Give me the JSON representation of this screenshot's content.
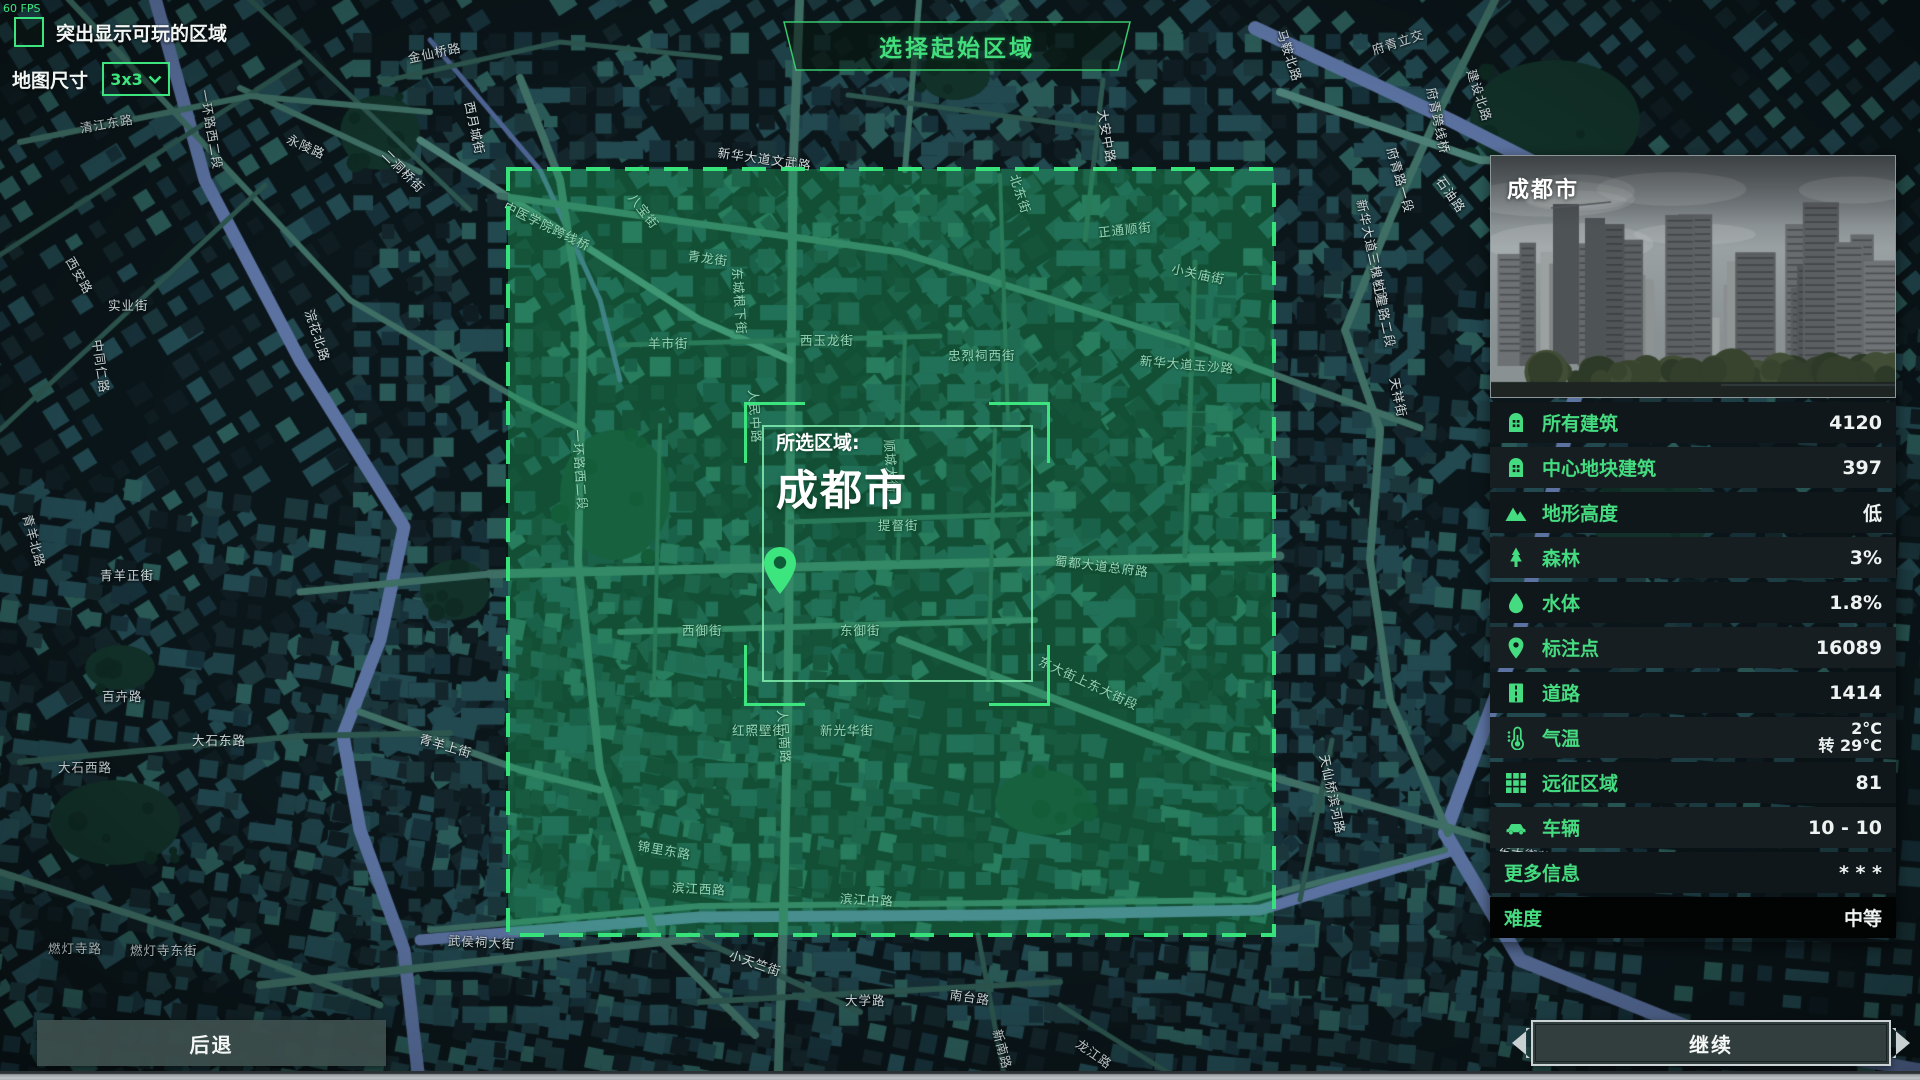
{
  "hud": {
    "fps": "60 FPS",
    "highlight_checkbox_label": "突出显示可玩的区域",
    "highlight_checked": false,
    "map_size_label": "地图尺寸",
    "map_size_value": "3x3"
  },
  "title": "选择起始区域",
  "selection": {
    "prefix": "所选区域:",
    "city": "成都市"
  },
  "panel": {
    "city_name": "成都市",
    "stats": [
      {
        "icon": "building-icon",
        "label": "所有建筑",
        "value": "4120"
      },
      {
        "icon": "building-icon",
        "label": "中心地块建筑",
        "value": "397"
      },
      {
        "icon": "mountain-icon",
        "label": "地形高度",
        "value": "低"
      },
      {
        "icon": "tree-icon",
        "label": "森林",
        "value": "3%"
      },
      {
        "icon": "water-drop-icon",
        "label": "水体",
        "value": "1.8%"
      },
      {
        "icon": "map-pin-icon",
        "label": "标注点",
        "value": "16089"
      },
      {
        "icon": "road-icon",
        "label": "道路",
        "value": "1414"
      },
      {
        "icon": "thermometer-icon",
        "label": "气温",
        "value": "2°C",
        "value2": "转 29°C"
      },
      {
        "icon": "grid-icon",
        "label": "远征区域",
        "value": "81"
      },
      {
        "icon": "car-icon",
        "label": "车辆",
        "value": "10 - 10"
      }
    ],
    "more_info": {
      "label": "更多信息",
      "value": "* * *"
    },
    "difficulty": {
      "label": "难度",
      "value": "中等"
    }
  },
  "buttons": {
    "back": "后退",
    "continue": "继续"
  },
  "colors": {
    "accent": "#3ce57d",
    "label_green": "#45db80",
    "value_white": "#eef3f2",
    "map_base": "#0b161a",
    "river": "#5c73a2",
    "river_thin": "#4d6391",
    "park": "#123129",
    "road_major": "#3e6e64",
    "road_bright": "#4c8076",
    "road_minor": "#2d564f",
    "buildings": [
      "#14262b",
      "#1b373c",
      "#224850",
      "#17313a",
      "#0f1d22",
      "#1e4147",
      "#2a5a57"
    ],
    "selection_fill": "rgba(34,197,107,0.33)",
    "selection_stroke": "#37e27a"
  },
  "map": {
    "street_labels": [
      {
        "t": "清江东路",
        "x": 80,
        "y": 118,
        "r": -10
      },
      {
        "t": "一环路西二段",
        "x": 205,
        "y": 80,
        "r": 80
      },
      {
        "t": "永陵路",
        "x": 288,
        "y": 128,
        "r": 24
      },
      {
        "t": "中医学院跨线桥",
        "x": 505,
        "y": 195,
        "r": 26
      },
      {
        "t": "浣花北路",
        "x": 310,
        "y": 300,
        "r": 72
      },
      {
        "t": "一环路西二段",
        "x": 578,
        "y": 420,
        "r": 86
      },
      {
        "t": "青羊上街",
        "x": 420,
        "y": 728,
        "r": 16
      },
      {
        "t": "青羊正街",
        "x": 100,
        "y": 565,
        "r": 0
      },
      {
        "t": "青羊北路",
        "x": 28,
        "y": 505,
        "r": 75
      },
      {
        "t": "西安路",
        "x": 70,
        "y": 248,
        "r": 60
      },
      {
        "t": "实业街",
        "x": 108,
        "y": 295,
        "r": 0
      },
      {
        "t": "中同仁路",
        "x": 98,
        "y": 330,
        "r": 82
      },
      {
        "t": "西月城街",
        "x": 470,
        "y": 92,
        "r": 78
      },
      {
        "t": "金仙桥路",
        "x": 408,
        "y": 48,
        "r": -12
      },
      {
        "t": "二洞桥街",
        "x": 385,
        "y": 142,
        "r": 45
      },
      {
        "t": "八宝街",
        "x": 632,
        "y": 185,
        "r": 52
      },
      {
        "t": "青龙街",
        "x": 688,
        "y": 245,
        "r": 8
      },
      {
        "t": "东城根下街",
        "x": 738,
        "y": 258,
        "r": 86
      },
      {
        "t": "羊市街",
        "x": 648,
        "y": 333,
        "r": 0
      },
      {
        "t": "西玉龙街",
        "x": 800,
        "y": 330,
        "r": 0
      },
      {
        "t": "新华大道文武路",
        "x": 718,
        "y": 142,
        "r": 8
      },
      {
        "t": "正通顺街",
        "x": 1098,
        "y": 222,
        "r": -6
      },
      {
        "t": "北东街",
        "x": 1015,
        "y": 165,
        "r": 72
      },
      {
        "t": "小关庙街",
        "x": 1172,
        "y": 258,
        "r": 12
      },
      {
        "t": "大安中路",
        "x": 1103,
        "y": 100,
        "r": 80
      },
      {
        "t": "府青立交",
        "x": 1372,
        "y": 40,
        "r": -18
      },
      {
        "t": "府青跨线桥",
        "x": 1432,
        "y": 78,
        "r": 78
      },
      {
        "t": "府青路一段",
        "x": 1392,
        "y": 138,
        "r": 74
      },
      {
        "t": "石油路",
        "x": 1440,
        "y": 168,
        "r": 55
      },
      {
        "t": "马鞍北路",
        "x": 1282,
        "y": 20,
        "r": 72
      },
      {
        "t": "新华大道三槐树路",
        "x": 1362,
        "y": 190,
        "r": 78
      },
      {
        "t": "建设北路",
        "x": 1472,
        "y": 60,
        "r": 72
      },
      {
        "t": "天祥街",
        "x": 1395,
        "y": 368,
        "r": 78
      },
      {
        "t": "红星路二段",
        "x": 1378,
        "y": 272,
        "r": 78
      },
      {
        "t": "新华大道玉沙路",
        "x": 1140,
        "y": 350,
        "r": 5
      },
      {
        "t": "忠烈祠西街",
        "x": 948,
        "y": 345,
        "r": 0
      },
      {
        "t": "顺城大街",
        "x": 890,
        "y": 430,
        "r": 86
      },
      {
        "t": "人民中路",
        "x": 754,
        "y": 380,
        "r": 86
      },
      {
        "t": "提督街",
        "x": 878,
        "y": 515,
        "r": 0
      },
      {
        "t": "蜀都大道总府路",
        "x": 1055,
        "y": 550,
        "r": 7
      },
      {
        "t": "西御街",
        "x": 682,
        "y": 620,
        "r": 0
      },
      {
        "t": "东御街",
        "x": 840,
        "y": 620,
        "r": 0
      },
      {
        "t": "人民南路",
        "x": 783,
        "y": 700,
        "r": 86
      },
      {
        "t": "东大街上东大街段",
        "x": 1040,
        "y": 650,
        "r": 25
      },
      {
        "t": "红照壁街",
        "x": 732,
        "y": 720,
        "r": 0
      },
      {
        "t": "新光华街",
        "x": 820,
        "y": 720,
        "r": 0
      },
      {
        "t": "滨江西路",
        "x": 672,
        "y": 877,
        "r": 3
      },
      {
        "t": "滨江中路",
        "x": 840,
        "y": 888,
        "r": 3
      },
      {
        "t": "锦里东路",
        "x": 638,
        "y": 835,
        "r": 10
      },
      {
        "t": "武侯祠大街",
        "x": 448,
        "y": 930,
        "r": 3
      },
      {
        "t": "小天竺街",
        "x": 730,
        "y": 944,
        "r": 19
      },
      {
        "t": "大学路",
        "x": 845,
        "y": 990,
        "r": 0
      },
      {
        "t": "南台路",
        "x": 950,
        "y": 984,
        "r": 8
      },
      {
        "t": "龙江路",
        "x": 1078,
        "y": 1032,
        "r": 35
      },
      {
        "t": "新南路",
        "x": 998,
        "y": 1020,
        "r": 75
      },
      {
        "t": "燃灯寺路",
        "x": 48,
        "y": 938,
        "r": 0
      },
      {
        "t": "燃灯寺东街",
        "x": 130,
        "y": 940,
        "r": 0
      },
      {
        "t": "百卉路",
        "x": 102,
        "y": 686,
        "r": 0
      },
      {
        "t": "大石西路",
        "x": 58,
        "y": 757,
        "r": 0
      },
      {
        "t": "大石东路",
        "x": 192,
        "y": 730,
        "r": 0
      },
      {
        "t": "天仙桥滨河路",
        "x": 1325,
        "y": 745,
        "r": 78
      },
      {
        "t": "东大街芷泉段",
        "x": 1498,
        "y": 840,
        "r": 8
      }
    ]
  }
}
